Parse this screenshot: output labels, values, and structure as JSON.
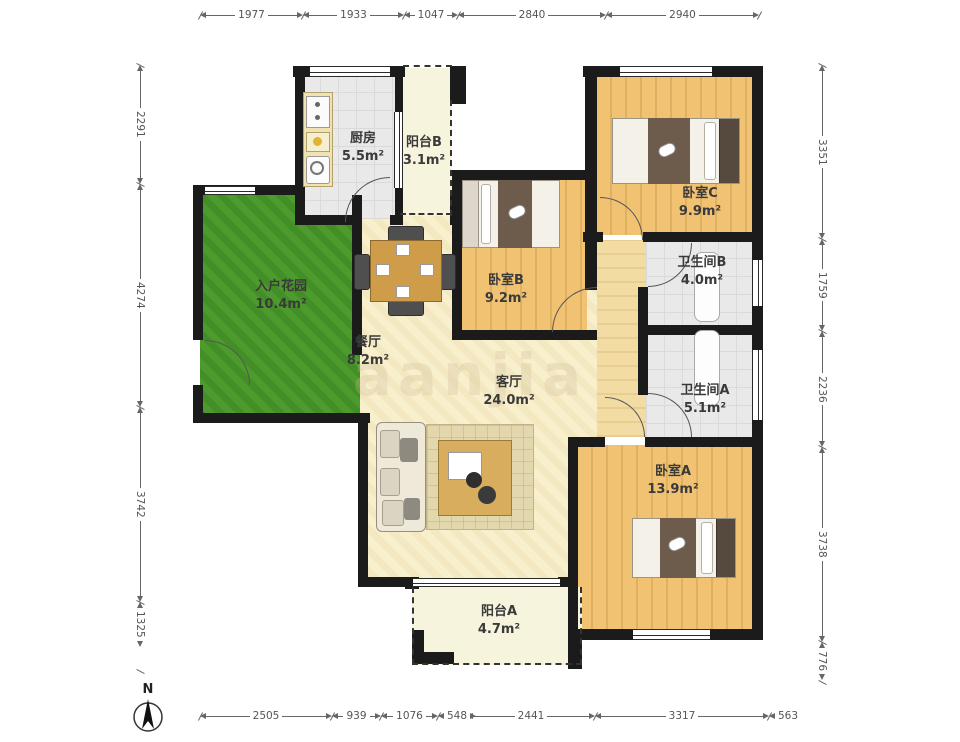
{
  "plan_type": "apartment-floor-plan",
  "compass": {
    "label": "N"
  },
  "watermark": "aanjia",
  "rooms": [
    {
      "id": "kitchen",
      "name": "厨房",
      "area": "5.5m²"
    },
    {
      "id": "balcony-b",
      "name": "阳台B",
      "area": "3.1m²"
    },
    {
      "id": "bedroom-c",
      "name": "卧室C",
      "area": "9.9m²"
    },
    {
      "id": "entry-garden",
      "name": "入户花园",
      "area": "10.4m²"
    },
    {
      "id": "bedroom-b",
      "name": "卧室B",
      "area": "9.2m²"
    },
    {
      "id": "bathroom-b",
      "name": "卫生间B",
      "area": "4.0m²"
    },
    {
      "id": "dining",
      "name": "餐厅",
      "area": "8.2m²"
    },
    {
      "id": "living",
      "name": "客厅",
      "area": "24.0m²"
    },
    {
      "id": "bathroom-a",
      "name": "卫生间A",
      "area": "5.1m²"
    },
    {
      "id": "bedroom-a",
      "name": "卧室A",
      "area": "13.9m²"
    },
    {
      "id": "balcony-a",
      "name": "阳台A",
      "area": "4.7m²"
    }
  ],
  "dimensions": {
    "top": [
      "1977",
      "1933",
      "1047",
      "2840",
      "2940"
    ],
    "bottom": [
      "2505",
      "939",
      "1076",
      "548",
      "2441",
      "3317",
      "563"
    ],
    "left": [
      "2291",
      "4274",
      "3742",
      "1325"
    ],
    "right": [
      "3351",
      "1759",
      "2236",
      "3738",
      "776"
    ]
  },
  "colors": {
    "wall": "#1b1b1b",
    "wood_floor": "#f0c272",
    "living_floor": "#f8efcd",
    "tile_floor": "#e9e9e9",
    "grass": "#4d9b2d",
    "blanket": "#6d5b4c",
    "table_wood": "#cf9c49"
  }
}
